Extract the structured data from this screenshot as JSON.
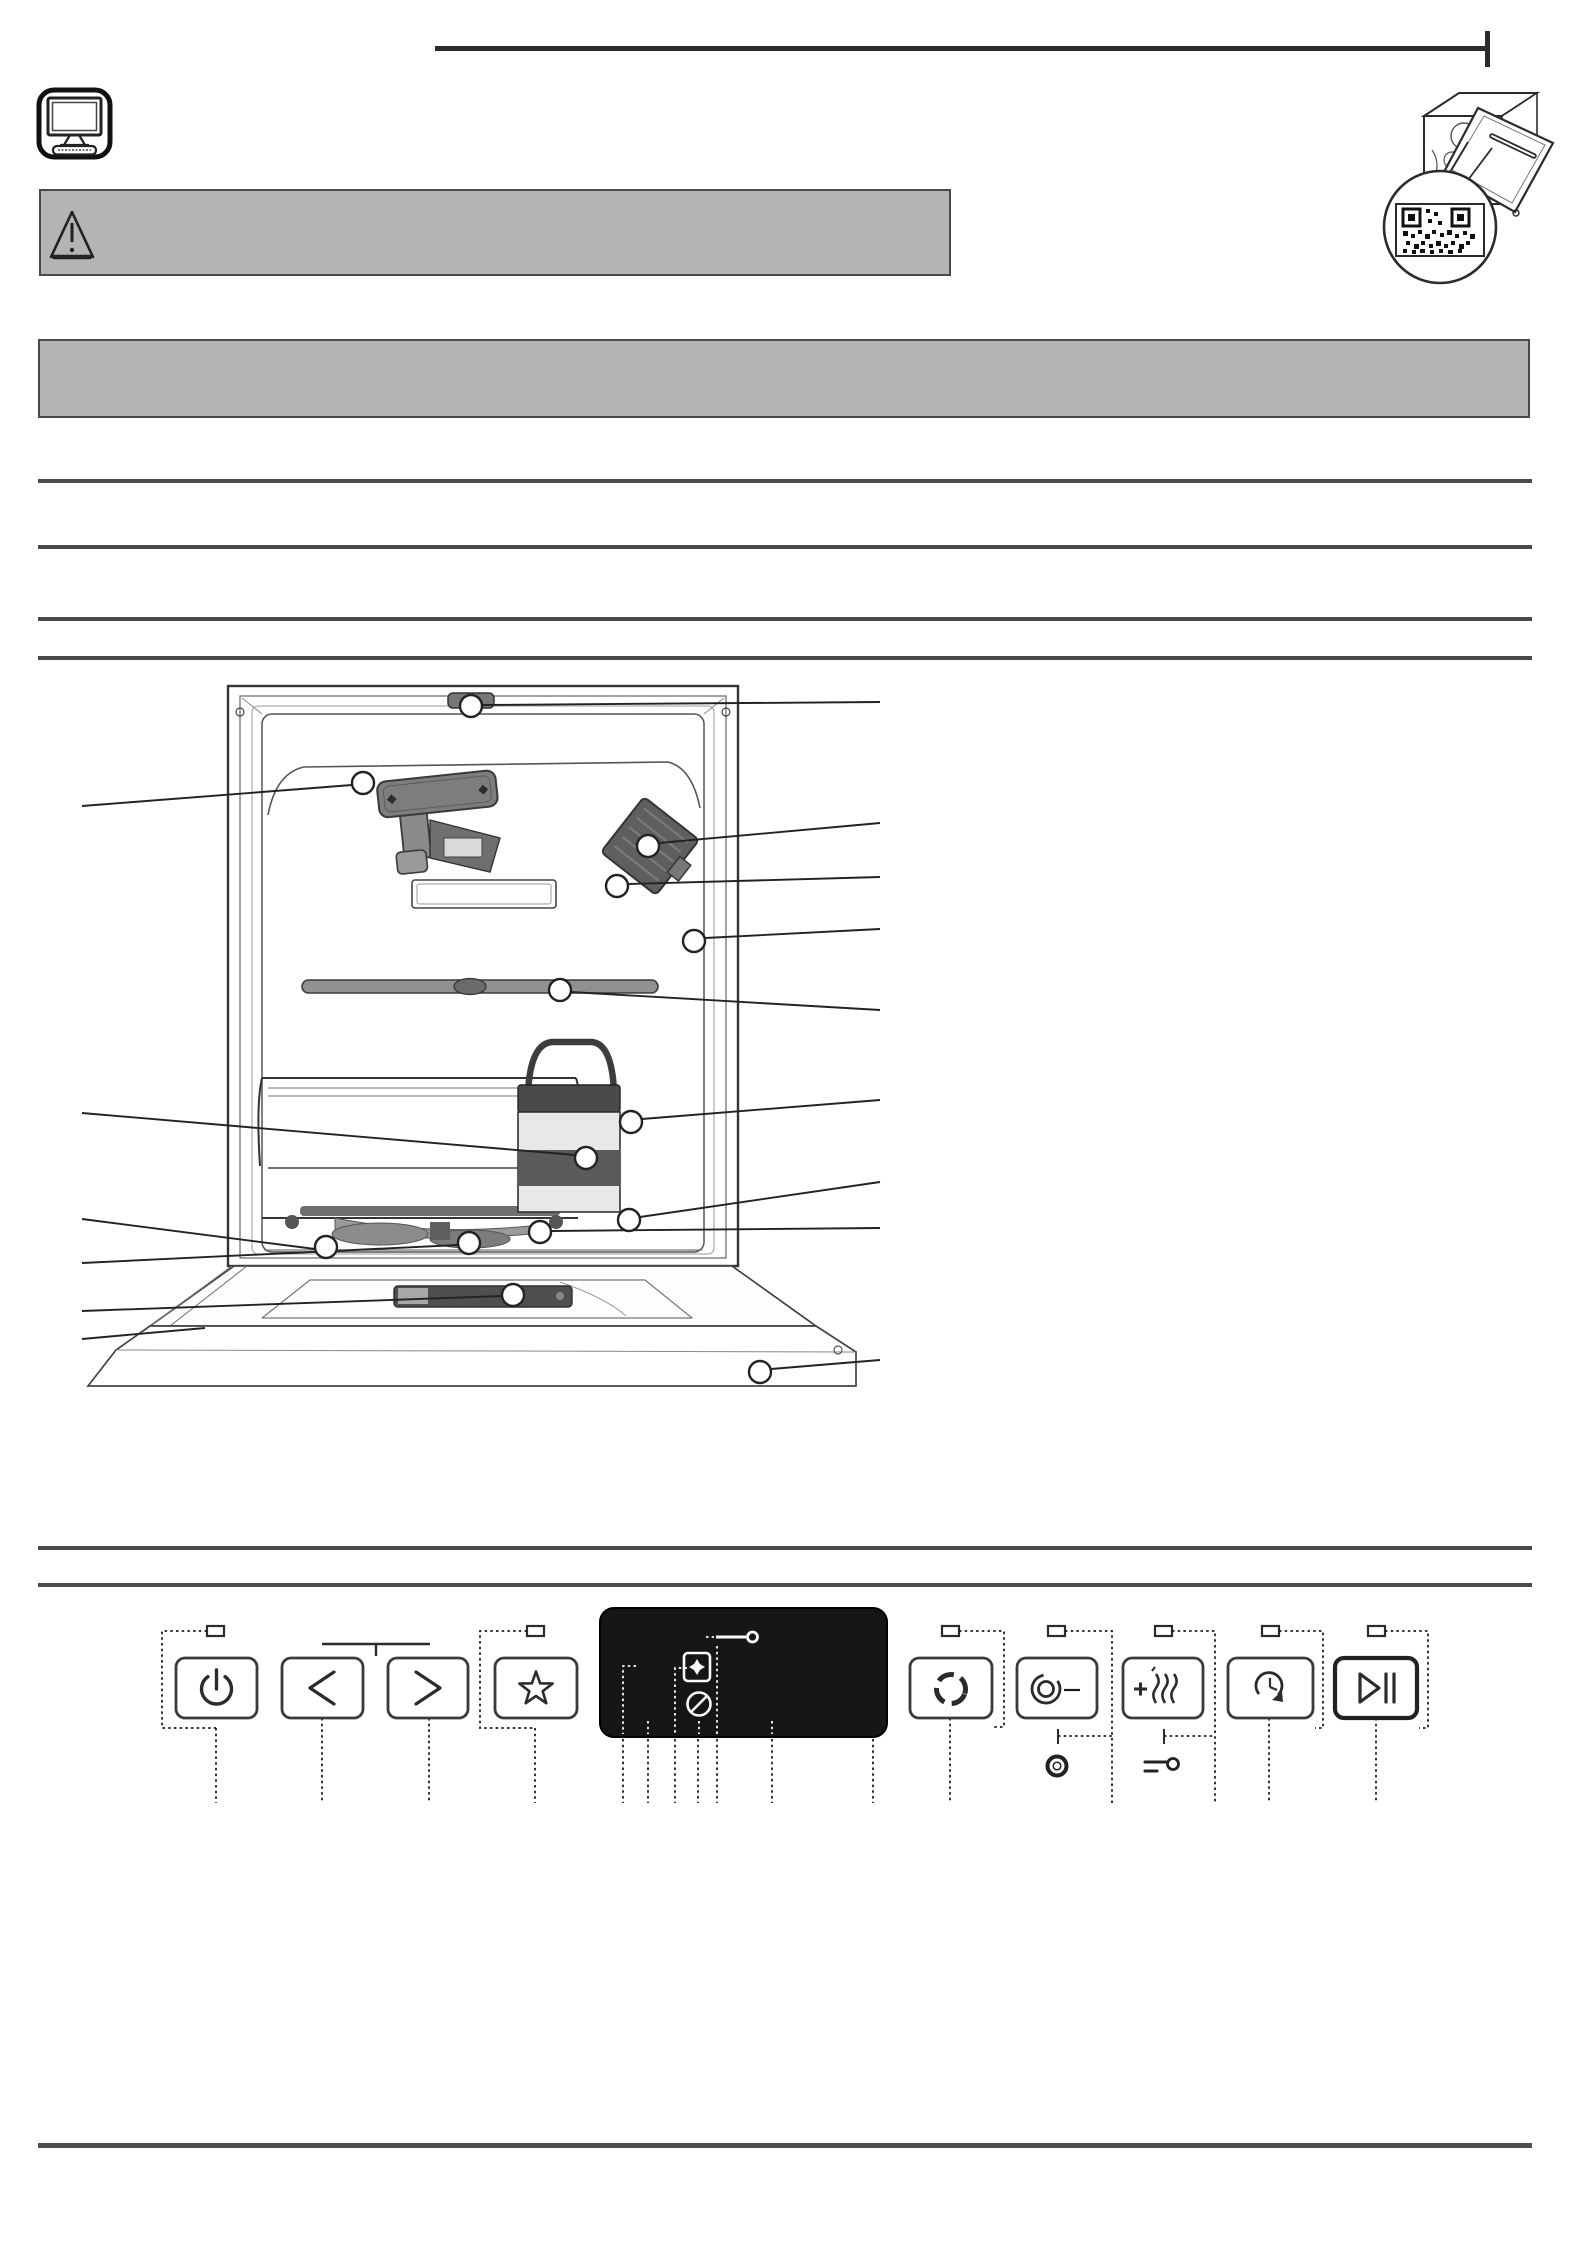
{
  "document": {
    "kind": "dishwasher daily reference guide",
    "brand": "Hotpoint"
  },
  "header": {
    "rule_color": "#2b2b2b",
    "monitor_icon": "monitor-keyboard-icon"
  },
  "warning_banner": {
    "bg": "#b4b4b4",
    "border": "#4a4a4a",
    "icon": "warning-triangle-icon",
    "text": ""
  },
  "info_banner": {
    "bg": "#b4b4b4",
    "border": "#4a4a4a",
    "text": ""
  },
  "diagram": {
    "description": "dishwasher interior exploded view with part callouts",
    "wash_zone_label": "WASH ZONE",
    "callout_count": 14,
    "qr_illustration": "dishwasher with magnified QR code"
  },
  "control_panel": {
    "program_label": "P",
    "display": {
      "value": "8:88",
      "salt_indicator": "S",
      "icons": [
        "salt-indicator",
        "rinse-aid-indicator",
        "tablet-indicator",
        "no-rinse-aid-indicator",
        "key-lock-indicator"
      ]
    },
    "buttons": [
      {
        "id": "power",
        "icon": "power-icon"
      },
      {
        "id": "program-prev",
        "icon": "chevron-left-icon"
      },
      {
        "id": "program-next",
        "icon": "chevron-right-icon"
      },
      {
        "id": "favorite",
        "icon": "star-icon"
      },
      {
        "id": "zone-wash",
        "icon": "zone-wash-icon",
        "label": "3D"
      },
      {
        "id": "half-load",
        "icon": "half-load-icon",
        "fraction_top": "1",
        "fraction_bottom": "2"
      },
      {
        "id": "extra-dry",
        "icon": "extra-dry-icon"
      },
      {
        "id": "delay-timer",
        "icon": "delay-timer-icon",
        "label": "h"
      },
      {
        "id": "start-pause",
        "icon": "play-pause-icon"
      }
    ],
    "hold_hints": [
      {
        "icon": "gear-icon",
        "label": "3 sec."
      },
      {
        "icon": "key-icon",
        "label": "3 sec."
      }
    ]
  },
  "footer": {
    "brand_logo": "Hotpoint"
  }
}
